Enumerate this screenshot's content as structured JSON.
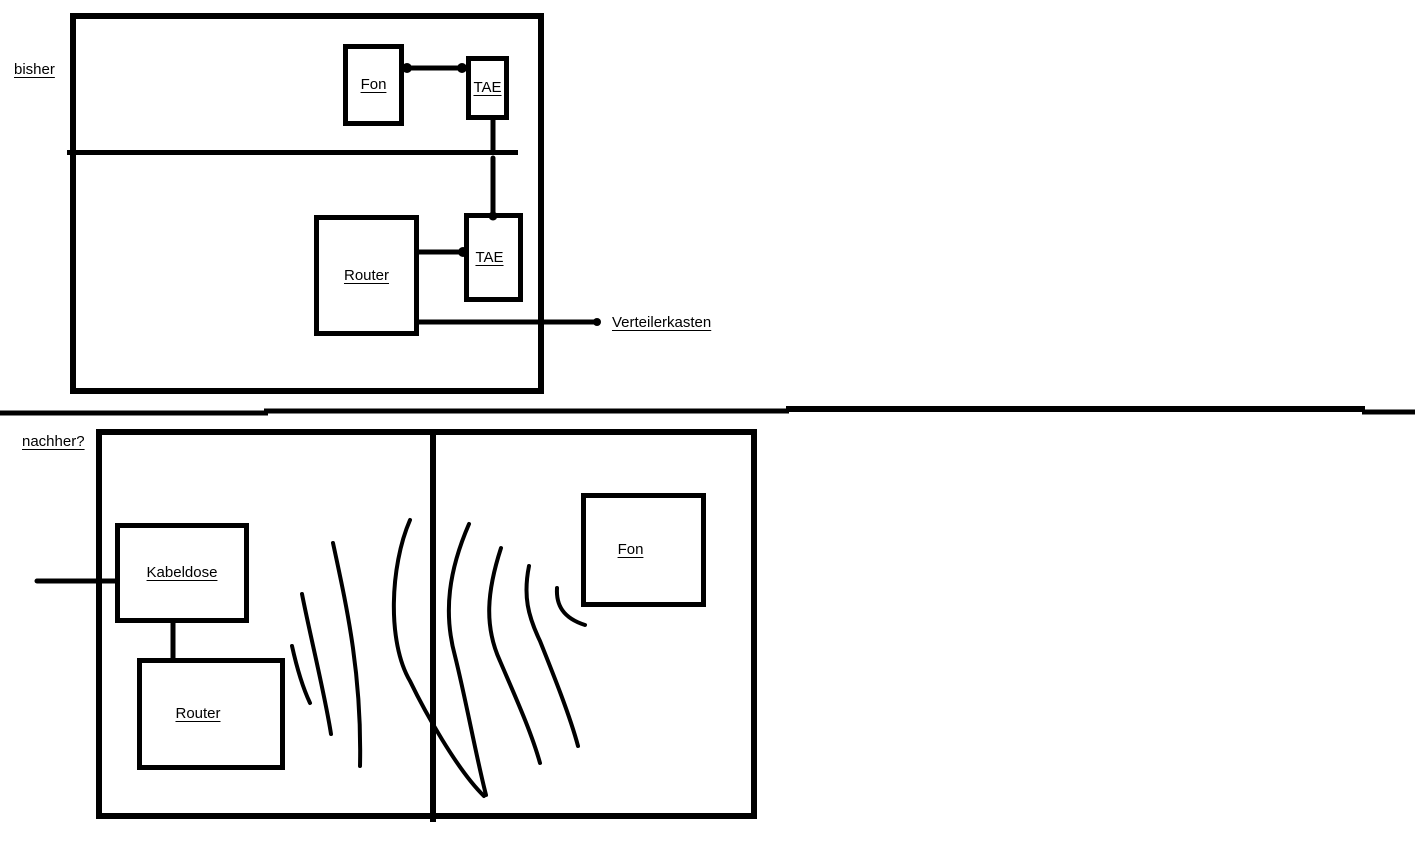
{
  "canvas": {
    "background_color": "#ffffff",
    "ink_color": "#000000"
  },
  "before": {
    "section_label": "bisher",
    "fon_label": "Fon",
    "tae_upper_label": "TAE",
    "router_label": "Router",
    "tae_lower_label": "TAE",
    "verteilerkasten_label": "Verteilerkasten"
  },
  "after": {
    "section_label": "nachher?",
    "kabeldose_label": "Kabeldose",
    "router_label": "Router",
    "fon_label": "Fon"
  }
}
